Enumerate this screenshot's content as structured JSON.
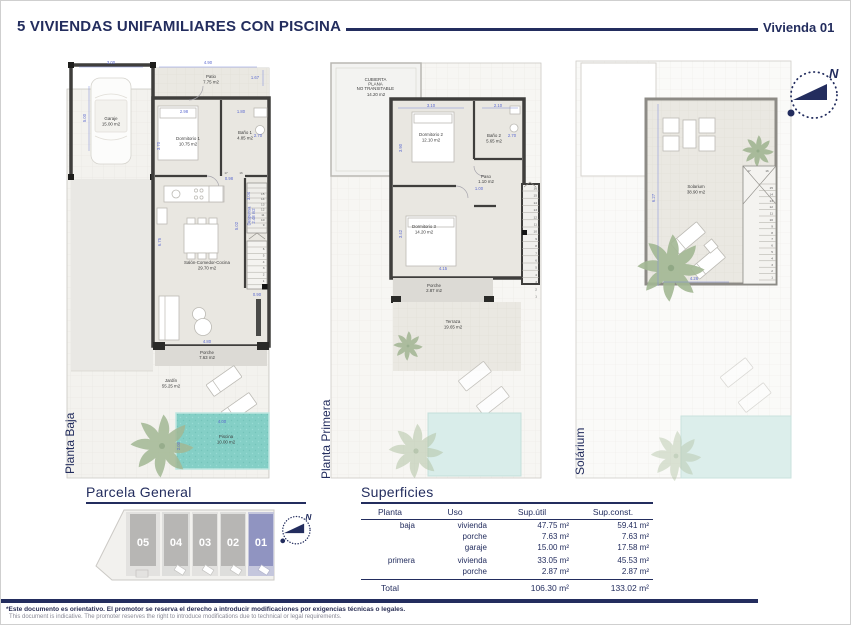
{
  "header": {
    "title": "5 VIVIENDAS UNIFAMILIARES CON PISCINA",
    "unit": "Vivienda 01"
  },
  "compass": {
    "north": "N"
  },
  "plans": {
    "baja": {
      "label": "Planta Baja",
      "rooms": {
        "garaje": {
          "name": "Garaje",
          "area": "15.00 m2"
        },
        "patio": {
          "name": "Patio",
          "area": "7.75 m2"
        },
        "dormitorio1": {
          "name": "Dormitorio 1",
          "area": "10.75 m2"
        },
        "bano1": {
          "name": "Baño 1",
          "area": "4.85 m2"
        },
        "despensa": {
          "name": "Despensa",
          "area": "2.48 m2"
        },
        "salon": {
          "name": "Salón-Comedor-Cocina",
          "area": "29.70 m2"
        },
        "porche": {
          "name": "Porche",
          "area": "7.63 m2"
        },
        "jardin": {
          "name": "Jardín",
          "area": "55.25 m2"
        },
        "piscina": {
          "name": "Piscina",
          "area": "10.00 m2"
        }
      },
      "dims": {
        "garage_w": "3.00",
        "patio_w": "4.90",
        "patio_r": "1.67",
        "garage_h": "5.00",
        "dorm1_w": "2.98",
        "bano1_w": "1.80",
        "dorm1_h": "3.70",
        "bano1_h": "2.70",
        "hall": "0.98",
        "s17": "17",
        "s16": "16",
        "despensa_h": "3.04",
        "mid_h": "5.02",
        "salon_h": "6.75",
        "stair_w": "0.90",
        "porche_w": "4.80",
        "pool_w": "4.00",
        "pool_h": "2.00"
      },
      "stairs_upper": [
        "15",
        "14",
        "13",
        "12",
        "11",
        "10",
        "9"
      ],
      "stairs_lower": [
        "6",
        "5",
        "4",
        "3",
        "2",
        "1"
      ]
    },
    "primera": {
      "label": "Planta Primera",
      "rooms": {
        "cubierta": {
          "l1": "CUBIERTA",
          "l2": "PLANA",
          "l3": "NO TRANSITABLE",
          "area": "14.20 m2"
        },
        "dormitorio2": {
          "name": "Dormitorio 2",
          "area": "12.10 m2"
        },
        "bano2": {
          "name": "Baño 2",
          "area": "5.65 m2"
        },
        "paso": {
          "name": "Paso",
          "area": "1.10 m2"
        },
        "dormitorio3": {
          "name": "Dormitorio 3",
          "area": "14.20 m2"
        },
        "porche": {
          "name": "Porche",
          "area": "2.87 m2"
        },
        "terraza": {
          "name": "Terraza",
          "area": "19.65 m2"
        }
      },
      "dims": {
        "dorm2_w": "3.10",
        "bano2_w": "2.10",
        "dorm2_h": "3.90",
        "bano2_h": "2.70",
        "paso_w": "1.00",
        "dorm3_h": "3.42",
        "dorm3_w": "4.15"
      },
      "stairs": [
        "16",
        "15",
        "14",
        "13",
        "12",
        "11",
        "10",
        "9",
        "8",
        "7",
        "6",
        "5",
        "4",
        "3",
        "2",
        "1"
      ]
    },
    "solarium": {
      "label": "Solárium",
      "rooms": {
        "solarium": {
          "name": "Solarium",
          "area": "38.90 m2"
        }
      },
      "dims": {
        "h": "6.27",
        "w": "4.26",
        "s17": "17",
        "s16": "16"
      },
      "stairs": [
        "15",
        "14",
        "13",
        "12",
        "11",
        "10",
        "9",
        "8",
        "7",
        "6",
        "5",
        "4",
        "3",
        "2",
        "1"
      ]
    }
  },
  "parcela": {
    "title": "Parcela General",
    "plots": [
      {
        "num": "05"
      },
      {
        "num": "04"
      },
      {
        "num": "03"
      },
      {
        "num": "02"
      },
      {
        "num": "01"
      }
    ]
  },
  "superficies": {
    "title": "Superficies",
    "headers": [
      "Planta",
      "Uso",
      "Sup.útil",
      "Sup.const."
    ],
    "rows": [
      {
        "planta": "baja",
        "uso": "vivienda",
        "util": "47.75 m²",
        "const": "59.41 m²"
      },
      {
        "planta": "",
        "uso": "porche",
        "util": "7.63 m²",
        "const": "7.63 m²"
      },
      {
        "planta": "",
        "uso": "garaje",
        "util": "15.00 m²",
        "const": "17.58 m²"
      },
      {
        "planta": "primera",
        "uso": "vivienda",
        "util": "33.05 m²",
        "const": "45.53 m²"
      },
      {
        "planta": "",
        "uso": "porche",
        "util": "2.87 m²",
        "const": "2.87 m²"
      }
    ],
    "total": {
      "label": "Total",
      "util": "106.30 m²",
      "const": "133.02 m²"
    }
  },
  "footer": {
    "line1": "*Este documento es orientativo. El promotor se reserva el derecho a introducir modificaciones por exigencias técnicas o legales.",
    "line2": "This document is indicative. The promoter reserves the right to introduce modifications due to technical or legal requirements."
  },
  "colors": {
    "navy": "#232d5e",
    "pool": "#84cfc6",
    "highlight_plot": "#9094c1",
    "dim_blue": "#5a68cf"
  }
}
